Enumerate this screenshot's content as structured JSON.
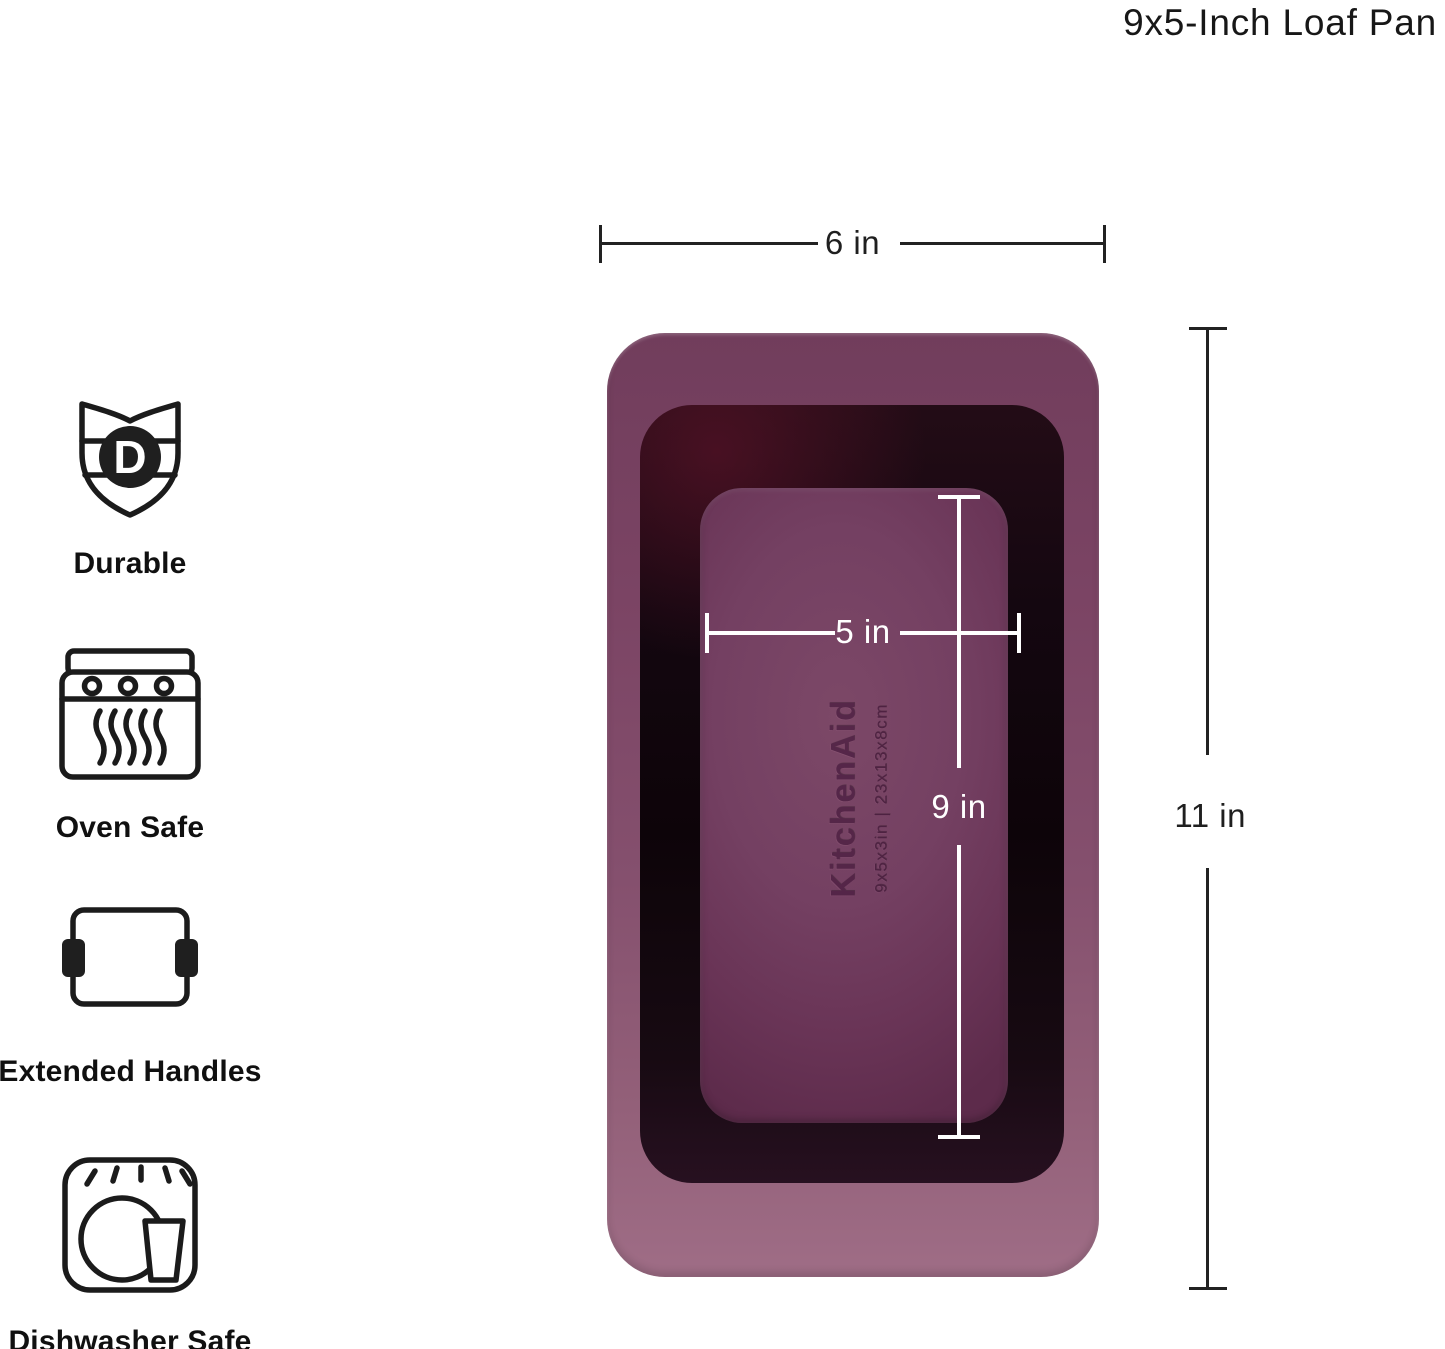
{
  "page": {
    "title": "9x5-Inch Loaf Pan"
  },
  "features": [
    {
      "label": "Durable",
      "icon": "durable-shield-icon",
      "badge_letter": "D"
    },
    {
      "label": "Oven Safe",
      "icon": "oven-icon"
    },
    {
      "label": "Extended Handles",
      "icon": "extended-handles-icon"
    },
    {
      "label": "Dishwasher Safe",
      "icon": "dishwasher-icon"
    }
  ],
  "product": {
    "brand": "KitchenAid",
    "embossed_size": "9x5x3in | 23x13x8cm",
    "colors": {
      "rim": "#82496a",
      "cavity": "#140710",
      "base": "#6e3a5a",
      "inner_dimension_lines": "#ffffff",
      "outer_dimension_lines": "#222222"
    }
  },
  "measurements": {
    "outer_width": "6 in",
    "outer_length": "11 in",
    "inner_width": "5 in",
    "inner_length": "9 in"
  }
}
